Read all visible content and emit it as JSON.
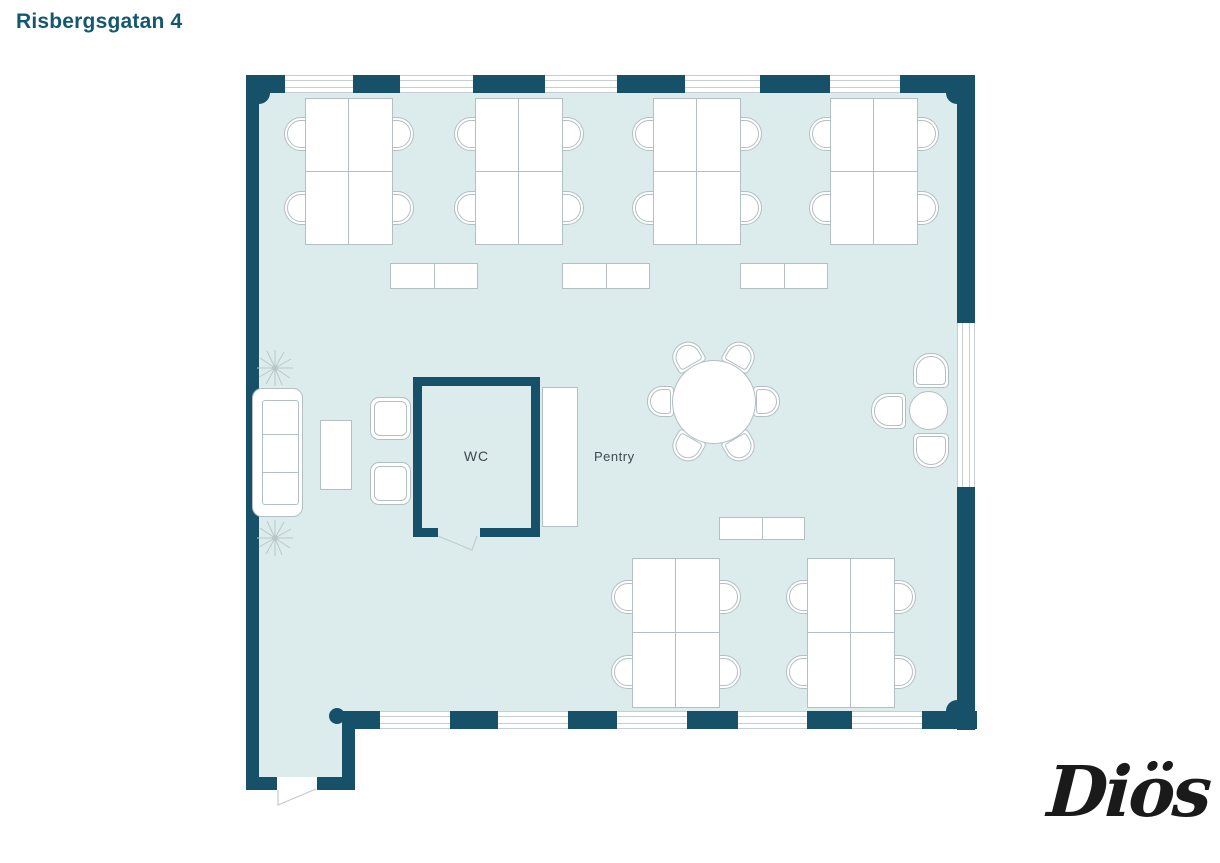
{
  "title": "Risbergsgatan 4",
  "labels": {
    "wc": "WC",
    "pentry": "Pentry"
  },
  "logo": {
    "text": "Diös"
  },
  "colors": {
    "wall": "#175169",
    "floor": "#dcecec",
    "stroke": "#b3bfc3",
    "window_line": "#c6ced2",
    "label_text": "#3d4a52",
    "title_text": "#14586f",
    "logo_text": "#1a1a1a"
  }
}
